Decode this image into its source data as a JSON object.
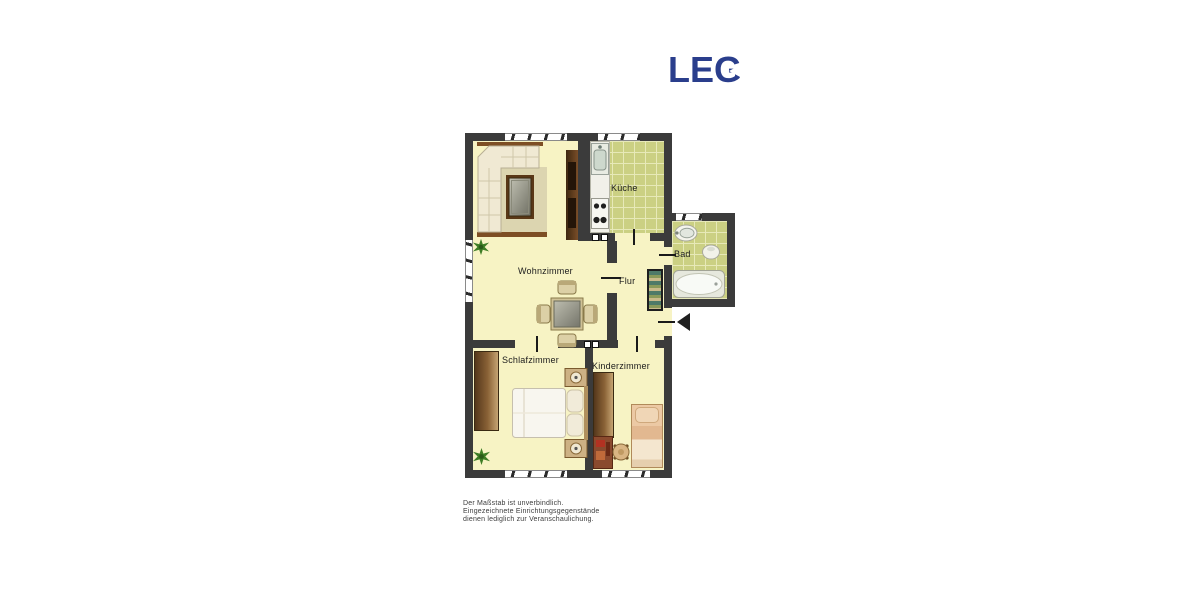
{
  "logo": {
    "text": "LEG",
    "color": "#2a3e8c"
  },
  "floorplan": {
    "rooms": [
      {
        "id": "wohnzimmer",
        "label": "Wohnzimmer",
        "furniture": [
          "corner-sofa",
          "rug",
          "coffee-table",
          "shelf-unit",
          "dining-table-with-4-chairs",
          "plant"
        ]
      },
      {
        "id": "kueche",
        "label": "Küche",
        "furniture": [
          "kitchen-counter",
          "sink",
          "stove"
        ]
      },
      {
        "id": "bad",
        "label": "Bad",
        "furniture": [
          "washbasin",
          "toilet",
          "bathtub"
        ]
      },
      {
        "id": "flur",
        "label": "Flur",
        "furniture": [
          "shelf"
        ]
      },
      {
        "id": "schlafzimmer",
        "label": "Schlafzimmer",
        "furniture": [
          "wardrobe",
          "double-bed",
          "nightstand-left",
          "nightstand-right",
          "plant"
        ]
      },
      {
        "id": "kinderzimmer",
        "label": "Kinderzimmer",
        "furniture": [
          "wardrobe",
          "desk",
          "chair",
          "single-bed"
        ]
      }
    ],
    "entrance_marker": "arrow-left"
  },
  "disclaimer": {
    "line1": "Der Maßstab ist unverbindlich.",
    "line2": "Eingezeichnete Einrichtungsgegenstände",
    "line3": "dienen lediglich zur Veranschaulichung."
  },
  "colors": {
    "wall": "#3b3b3b",
    "floor": "#f7f3c4",
    "tiles": "#cbd083",
    "logo_blue": "#2a3e8c"
  }
}
